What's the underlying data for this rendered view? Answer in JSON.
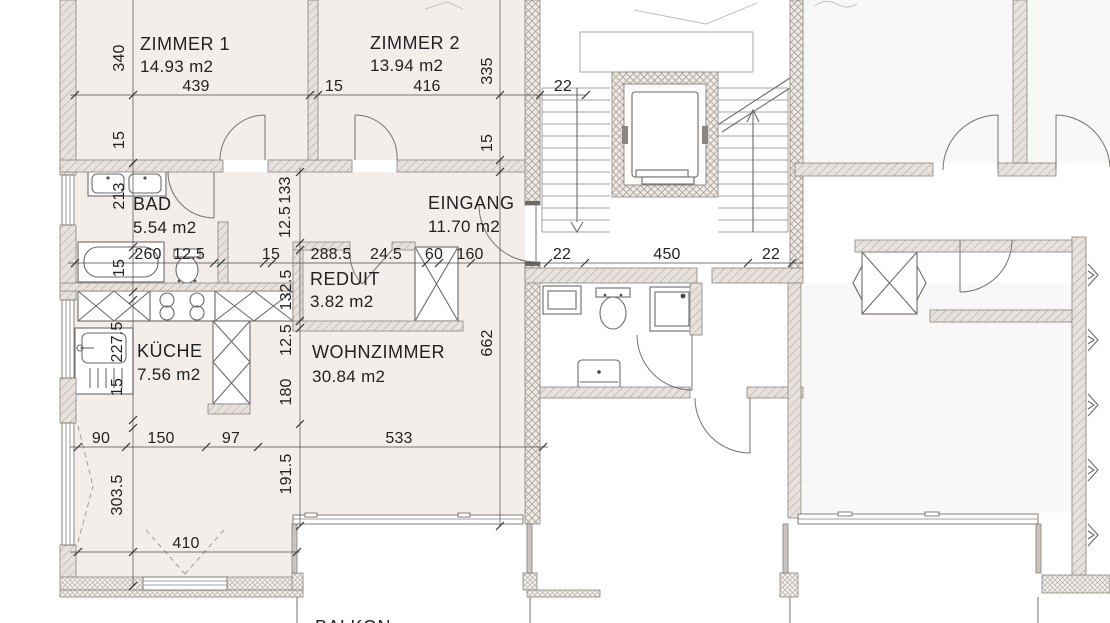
{
  "title": "Grundriss Wohnung (apartment floor plan)",
  "colors": {
    "paper": "#ffffff",
    "floor": "#f3eeea",
    "wall_fill": "#e7e2dd",
    "core_wall_fill": "#efeae5",
    "line": "#6e6a66",
    "text": "#222222"
  },
  "rooms": {
    "zimmer1": {
      "name": "ZIMMER 1",
      "area": "14.93 m2"
    },
    "zimmer2": {
      "name": "ZIMMER 2",
      "area": "13.94 m2"
    },
    "bad": {
      "name": "BAD",
      "area": "5.54 m2"
    },
    "eingang": {
      "name": "EINGANG",
      "area": "11.70 m2"
    },
    "reduit": {
      "name": "REDUIT",
      "area": "3.82 m2"
    },
    "kueche": {
      "name": "KÜCHE",
      "area": "7.56 m2"
    },
    "wohnzimmer": {
      "name": "WOHNZIMMER",
      "area": "30.84 m2"
    },
    "balkon": {
      "name": "BALKON"
    }
  },
  "dims": {
    "t439": "439",
    "t15": "15",
    "t416": "416",
    "t22": "22",
    "l340": "340",
    "l15a": "15",
    "l213": "213",
    "l15b": "15",
    "l2275": "227.5",
    "l15c": "15",
    "l3035": "303.5",
    "m260": "260",
    "m125": "12.5",
    "m15": "15",
    "m2885": "288.5",
    "m245": "24.5",
    "m60": "60",
    "m160": "160",
    "m22a": "22",
    "m450": "450",
    "m22b": "22",
    "c133": "133",
    "c125a": "12.5",
    "c1325": "132.5",
    "c125b": "12.5",
    "c180": "180",
    "c1915": "191.5",
    "r335": "335",
    "r15": "15",
    "r662": "662",
    "b90": "90",
    "b150": "150",
    "b97": "97",
    "b533": "533",
    "b410": "410"
  }
}
